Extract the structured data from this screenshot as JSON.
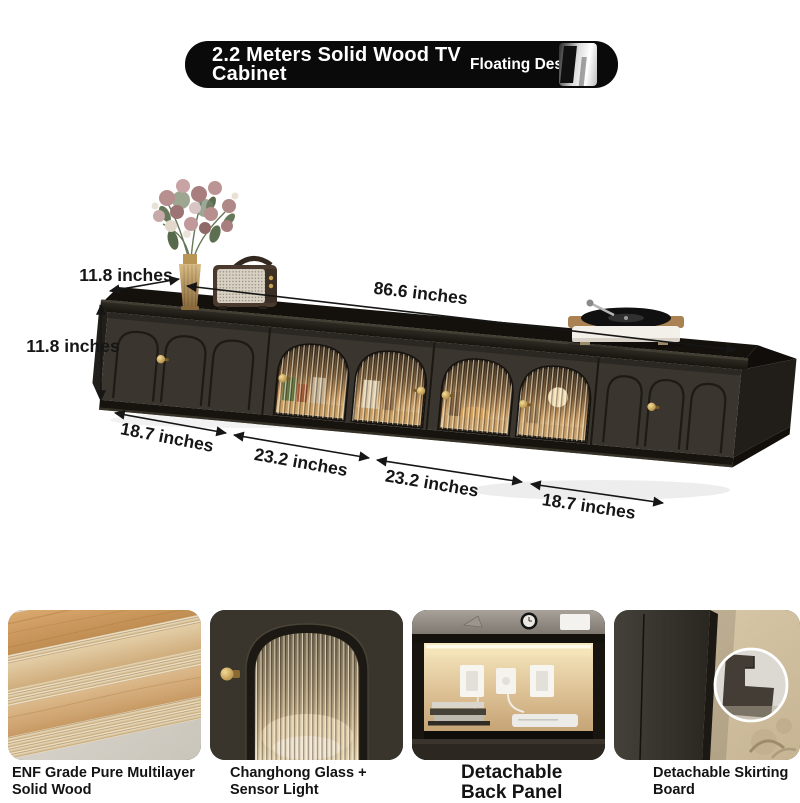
{
  "banner": {
    "title_line1": "2.2 Meters Solid Wood TV",
    "title_line2": "Cabinet",
    "badge": "Floating Design"
  },
  "dimensions": {
    "depth_label": "11.8 inches",
    "length_label": "86.6 inches",
    "height_label": "11.8 inches",
    "bottom_left_label": "18.7 inches",
    "bottom_mid1_label": "23.2 inches",
    "bottom_mid2_label": "23.2 inches",
    "bottom_right_label": "18.7 inches"
  },
  "features": [
    {
      "lines": [
        "ENF Grade Pure Multilayer",
        "Solid Wood"
      ]
    },
    {
      "lines": [
        "Changhong Glass +",
        "Sensor Light"
      ]
    },
    {
      "lines": [
        "Detachable",
        "Back Panel"
      ]
    },
    {
      "lines": [
        "Detachable Skirting",
        "Board"
      ]
    }
  ],
  "scene": {
    "decor_items": [
      "flower-vase",
      "retro-speaker",
      "record-player"
    ],
    "cabinet": "black floating tv cabinet with arched glass doors"
  },
  "colors": {
    "banner_bg": "#0a0a0a",
    "cabinet_body": "#3a362f",
    "cabinet_dark": "#17140f",
    "brass_accent": "#c9a254",
    "glass_glow": "#e9c896",
    "label_text": "#161616"
  }
}
